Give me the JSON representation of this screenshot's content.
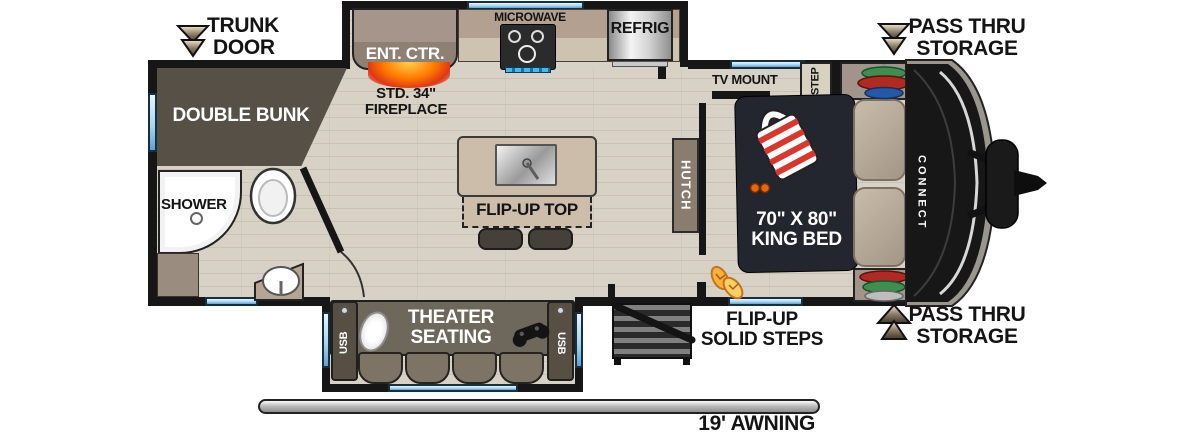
{
  "diagram": {
    "type": "travel-trailer-floorplan",
    "brand_mark": "CONNECT",
    "exterior": {
      "trunk_door_line1": "TRUNK",
      "trunk_door_line2": "DOOR",
      "pass_thru_top_line1": "PASS THRU",
      "pass_thru_top_line2": "STORAGE",
      "pass_thru_bottom_line1": "PASS THRU",
      "pass_thru_bottom_line2": "STORAGE",
      "awning_label": "19' AWNING"
    },
    "kitchen": {
      "microwave_label": "MICROWAVE",
      "refrigerator_label": "REFRIG",
      "entertainment_center_label": "ENT. CTR.",
      "fireplace_line1": "STD. 34\"",
      "fireplace_line2": "FIREPLACE",
      "island_label": "FLIP-UP TOP",
      "hutch_label": "HUTCH"
    },
    "bedroom": {
      "tv_mount_label": "TV MOUNT",
      "step_label": "STEP",
      "bed_line1": "70\" X 80\"",
      "bed_line2": "KING BED"
    },
    "bathroom": {
      "shower_label": "SHOWER"
    },
    "bunk_room": {
      "label": "DOUBLE BUNK"
    },
    "living_area": {
      "theater_line1": "THEATER",
      "theater_line2": "SEATING",
      "usb_left_label": "USB",
      "usb_right_label": "USB",
      "entry_steps_line1": "FLIP-UP",
      "entry_steps_line2": "SOLID STEPS"
    },
    "colors": {
      "wall": "#161616",
      "floor": "#d8d2c6",
      "window_blue": "#a9d6f2",
      "cabinet_tan": "#b7a593",
      "dark_wood": "#565047",
      "bed_navy": "#23262e",
      "sofa_brown": "#6e675b",
      "fireplace_orange": "#ff7a00"
    }
  }
}
